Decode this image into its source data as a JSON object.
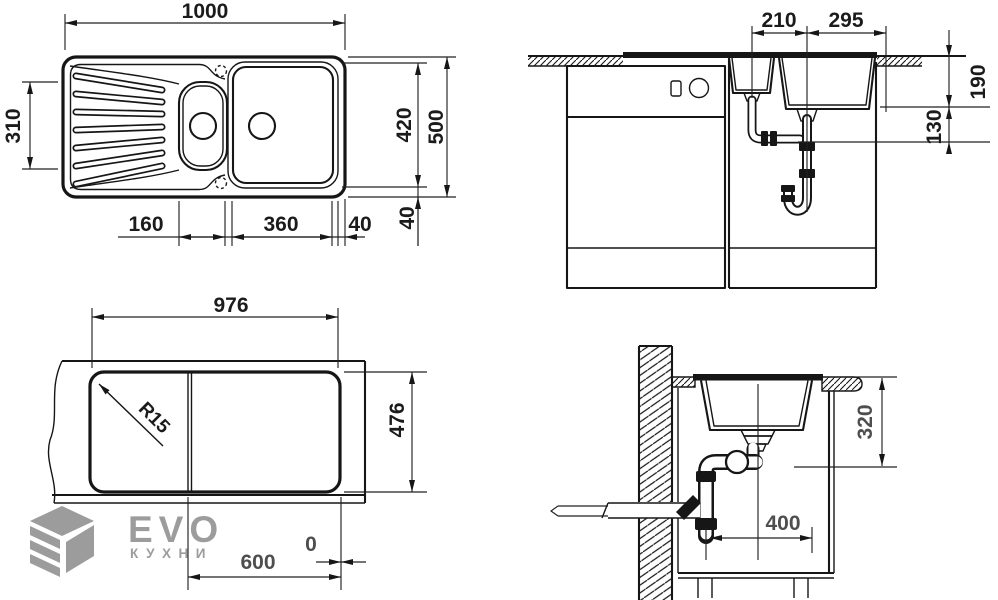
{
  "colors": {
    "line": "#161616",
    "dim_text": "#1b1b1b",
    "dim_text_muted": "#4e4e4e",
    "watermark": "#9c9c9c",
    "background": "#ffffff"
  },
  "views": {
    "plan": {
      "dims": {
        "overall_width": "1000",
        "drainer_depth": "310",
        "bowls_depth": "420",
        "overall_depth": "500",
        "small_bowl_width": "160",
        "main_bowl_width": "360",
        "right_margin": "40",
        "bottom_margin": "40"
      }
    },
    "front": {
      "dims": {
        "small_drain_offset": "210",
        "main_drain_offset": "295",
        "bowl_depth": "190",
        "clearance": "130"
      }
    },
    "cutout": {
      "dims": {
        "width": "976",
        "depth": "476",
        "radius": "R15",
        "cabinet": "600",
        "zero": "0"
      }
    },
    "side": {
      "dims": {
        "depth": "320",
        "drain": "400"
      }
    }
  },
  "logo": {
    "brand": "EVO",
    "subtitle": "КУХНИ"
  }
}
